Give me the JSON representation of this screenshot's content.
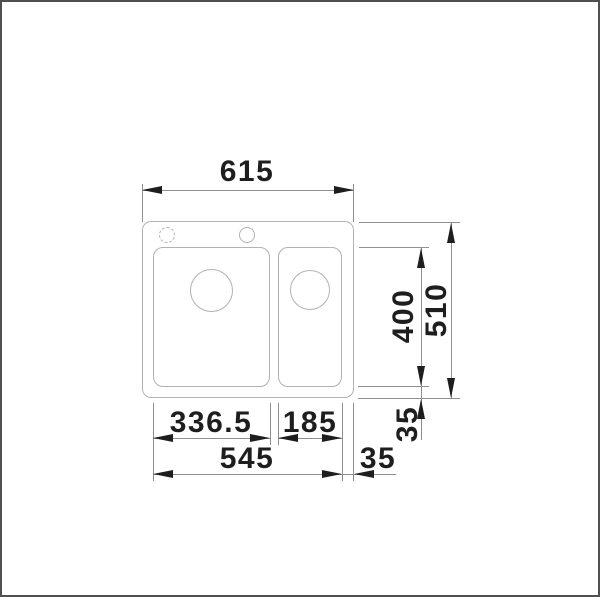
{
  "diagram": {
    "kind": "technical dimension drawing",
    "subject": "inset kitchen sink, one-and-a-half bowls, top view",
    "units": "mm"
  },
  "dimensions": {
    "overall_width": "615",
    "overall_depth": "510",
    "bowl_depth": "400",
    "main_bowl_width": "336.5",
    "half_bowl_width": "185",
    "bowls_total_width": "545",
    "side_offset": "35",
    "front_offset": "35"
  },
  "colors": {
    "ink": "#1e1e1e",
    "dimension_line": "#8f8f8f",
    "sink_outline": "#b2b2b2",
    "frame_border": "#4f4f4f",
    "background": "#ffffff"
  }
}
